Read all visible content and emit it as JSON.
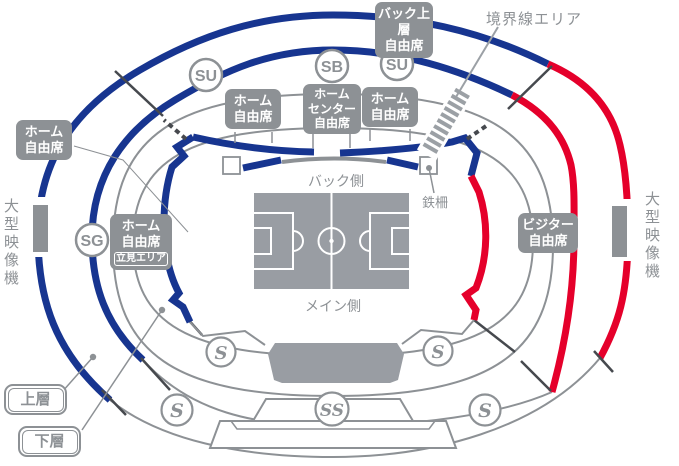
{
  "sections": {
    "back_upper": {
      "line1": "バック上層",
      "line2": "自由席"
    },
    "home_left": {
      "line1": "ホーム",
      "line2": "自由席"
    },
    "home_mid_left": {
      "line1": "ホーム",
      "line2": "自由席"
    },
    "home_center": {
      "line1": "ホーム",
      "line2": "センター",
      "line3": "自由席"
    },
    "home_mid_right": {
      "line1": "ホーム",
      "line2": "自由席"
    },
    "home_standing": {
      "line1": "ホーム",
      "line2": "自由席",
      "badge": "立見エリア"
    },
    "visitor": {
      "line1": "ビジター",
      "line2": "自由席"
    }
  },
  "badges": {
    "su_left": "SU",
    "sb": "SB",
    "su_right": "SU",
    "sg": "SG",
    "s_mid_left": "S",
    "s_mid_right": "S",
    "s_bottom_left": "S",
    "ss": "SS",
    "s_bottom_right": "S"
  },
  "annotations": {
    "boundary_area": "境界線エリア",
    "fence": "鉄柵",
    "back_side": "バック側",
    "main_side": "メイン側",
    "screen_left": "大型映像機",
    "screen_right": "大型映像機",
    "upper_tier": "上層",
    "lower_tier": "下層"
  },
  "colors": {
    "home_blue": "#173590",
    "visitor_red": "#E5002B",
    "line_gray": "#8D9195",
    "divider_dark": "#46494E"
  }
}
